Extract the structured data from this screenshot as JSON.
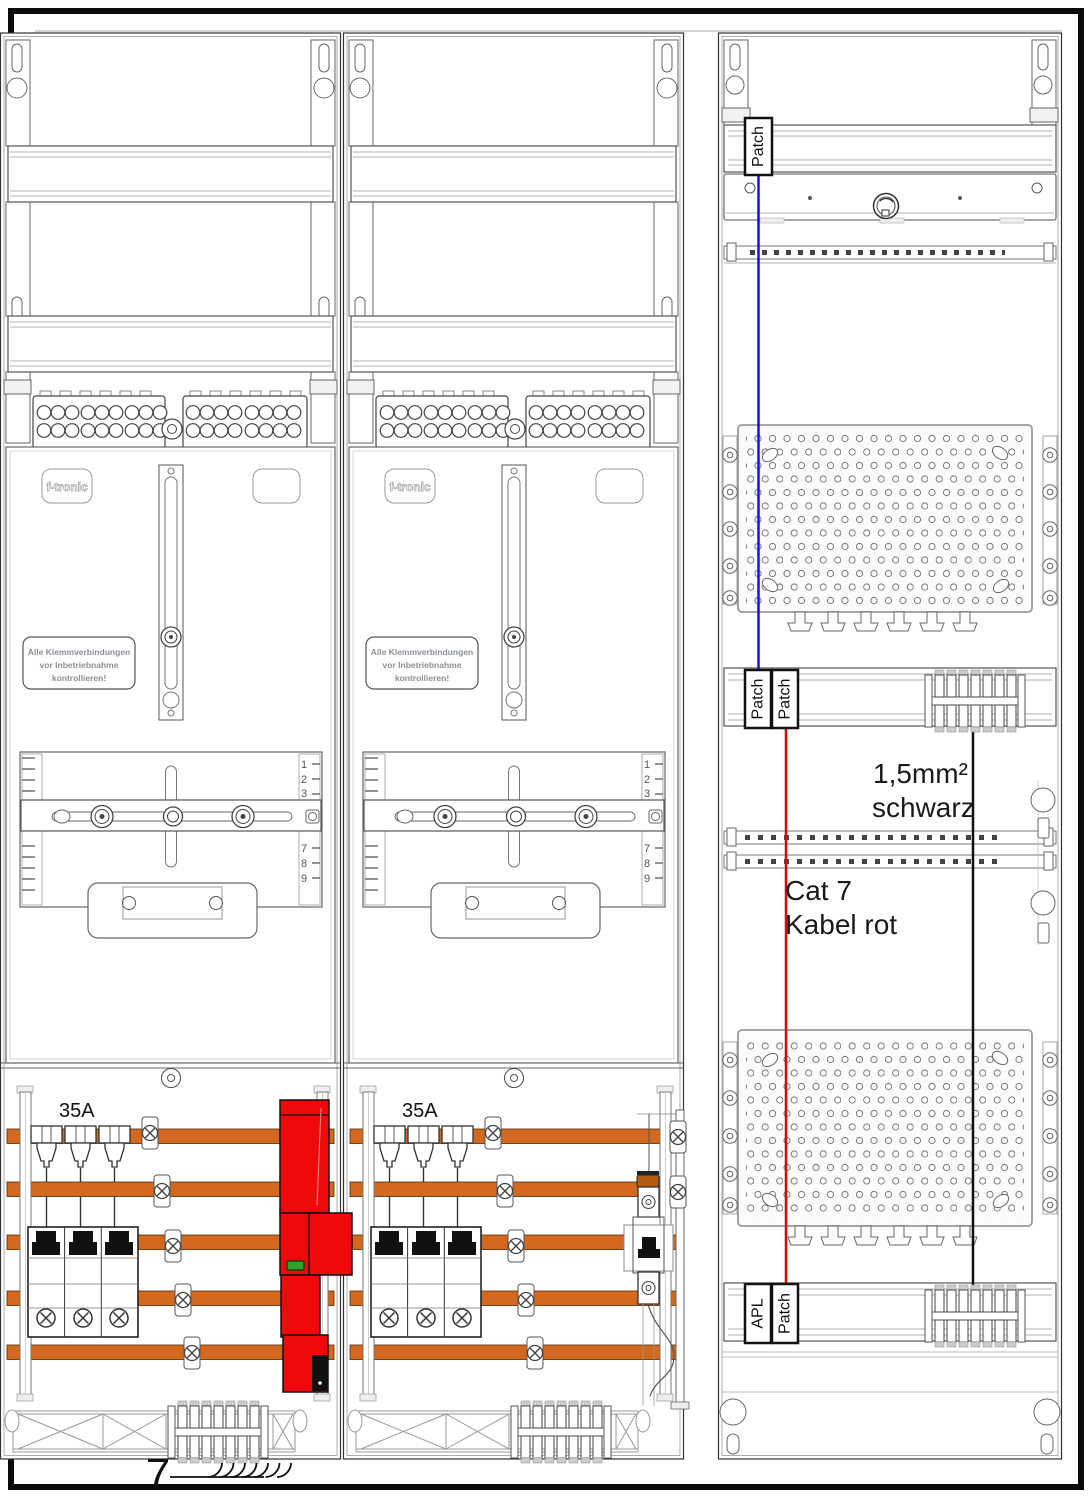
{
  "colors": {
    "busbar": "#D2691E",
    "device_red": "#EE0A0A",
    "led_green": "#2EA22A",
    "wire_blue": "#1616CE",
    "wire_red": "#E00000",
    "wire_black": "#111111"
  },
  "brand": "f-tronic",
  "warning_label": [
    "Alle Klemmverbindungen",
    "vor Inbetriebnahme",
    "kontrollieren!"
  ],
  "ruler": {
    "n1": "1",
    "n2": "2",
    "n3": "3",
    "n7": "7",
    "n8": "8",
    "n9": "9"
  },
  "meter_field": {
    "breaker_rating": "35A"
  },
  "comms_field": {
    "patch_top": "Patch",
    "patch_mid_left": "Patch",
    "patch_mid_right": "Patch",
    "apl": "APL",
    "patch_bottom": "Patch",
    "black_wire_label": [
      "1,5mm²",
      "schwarz"
    ],
    "red_wire_label": [
      "Cat 7",
      "Kabel rot"
    ]
  },
  "bottom": {
    "wire_count": "7"
  }
}
